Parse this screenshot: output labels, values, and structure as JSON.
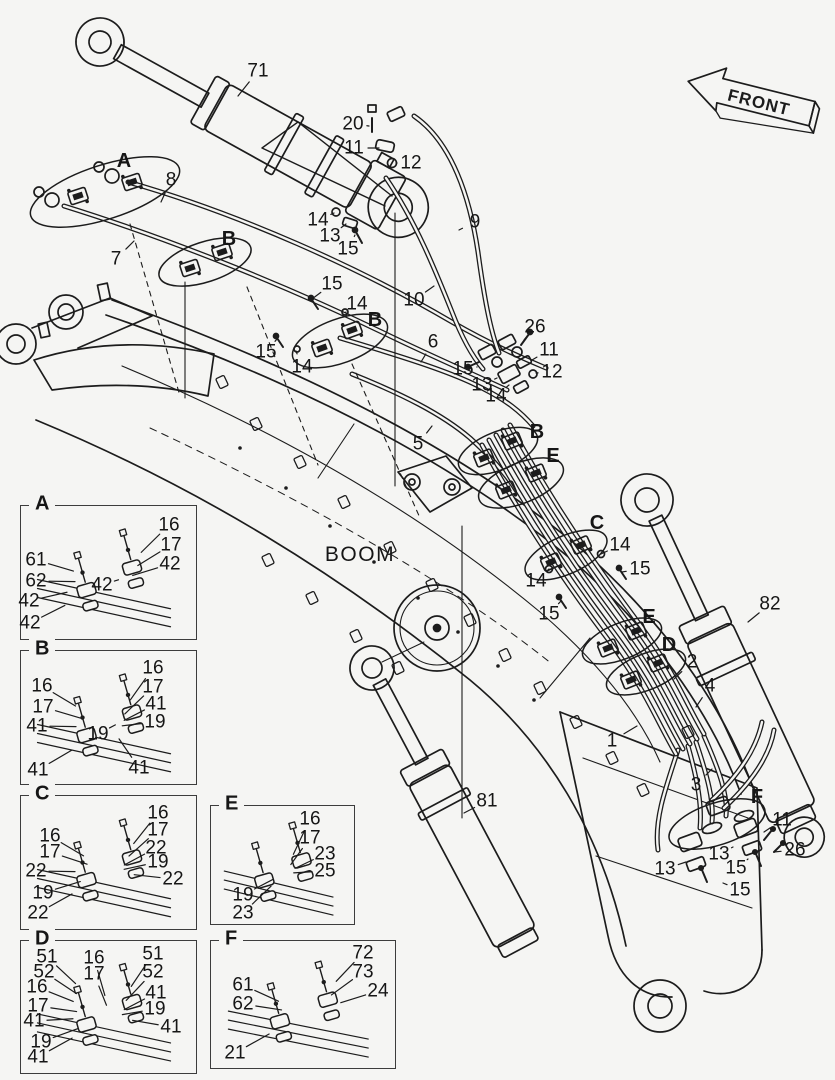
{
  "colors": {
    "background": "#f5f5f3",
    "line": "#1c1c1c"
  },
  "front_indicator": {
    "label": "FRONT"
  },
  "main_diagram": {
    "name_label": "BOOM",
    "part_labels": [
      {
        "text": "71",
        "x": 258,
        "y": 71,
        "lx": 238,
        "ly": 96
      },
      {
        "text": "20",
        "x": 353,
        "y": 124,
        "lx": 369,
        "ly": 126
      },
      {
        "text": "11",
        "x": 354,
        "y": 148,
        "lx": 379,
        "ly": 148
      },
      {
        "text": "12",
        "x": 411,
        "y": 163,
        "lx": 396,
        "ly": 163
      },
      {
        "text": "9",
        "x": 475,
        "y": 222,
        "lx": 459,
        "ly": 230
      },
      {
        "text": "14",
        "x": 318,
        "y": 220,
        "lx": 334,
        "ly": 213
      },
      {
        "text": "13",
        "x": 330,
        "y": 236,
        "lx": 346,
        "ly": 224
      },
      {
        "text": "15",
        "x": 348,
        "y": 249,
        "lx": 355,
        "ly": 235
      },
      {
        "text": "10",
        "x": 414,
        "y": 300,
        "lx": 434,
        "ly": 286
      },
      {
        "text": "A",
        "x": 124,
        "y": 161,
        "style": "letter"
      },
      {
        "text": "8",
        "x": 171,
        "y": 180,
        "lx": 161,
        "ly": 202
      },
      {
        "text": "7",
        "x": 116,
        "y": 259,
        "lx": 134,
        "ly": 241
      },
      {
        "text": "B",
        "x": 229,
        "y": 239,
        "style": "letter"
      },
      {
        "text": "15",
        "x": 332,
        "y": 284,
        "lx": 312,
        "ly": 299
      },
      {
        "text": "14",
        "x": 357,
        "y": 304,
        "lx": 346,
        "ly": 312
      },
      {
        "text": "15",
        "x": 266,
        "y": 352,
        "lx": 277,
        "ly": 339
      },
      {
        "text": "14",
        "x": 302,
        "y": 367,
        "lx": 296,
        "ly": 351
      },
      {
        "text": "B",
        "x": 375,
        "y": 320,
        "style": "letter"
      },
      {
        "text": "6",
        "x": 433,
        "y": 342,
        "lx": 421,
        "ly": 362
      },
      {
        "text": "26",
        "x": 535,
        "y": 327,
        "lx": 524,
        "ly": 340
      },
      {
        "text": "11",
        "x": 549,
        "y": 350,
        "lx": 532,
        "ly": 360
      },
      {
        "text": "12",
        "x": 552,
        "y": 372,
        "lx": 536,
        "ly": 373
      },
      {
        "text": "15",
        "x": 463,
        "y": 369,
        "lx": 477,
        "ly": 367
      },
      {
        "text": "13",
        "x": 482,
        "y": 385,
        "lx": 497,
        "ly": 378
      },
      {
        "text": "14",
        "x": 496,
        "y": 396,
        "lx": 509,
        "ly": 385
      },
      {
        "text": "5",
        "x": 418,
        "y": 444,
        "lx": 432,
        "ly": 426
      },
      {
        "text": "B",
        "x": 537,
        "y": 432,
        "style": "letter"
      },
      {
        "text": "E",
        "x": 553,
        "y": 456,
        "style": "letter"
      },
      {
        "text": "C",
        "x": 597,
        "y": 523,
        "style": "letter"
      },
      {
        "text": "14",
        "x": 620,
        "y": 545,
        "lx": 601,
        "ly": 554
      },
      {
        "text": "15",
        "x": 640,
        "y": 569,
        "lx": 622,
        "ly": 572
      },
      {
        "text": "14",
        "x": 536,
        "y": 581,
        "lx": 549,
        "ly": 569
      },
      {
        "text": "15",
        "x": 549,
        "y": 614,
        "lx": 561,
        "ly": 601
      },
      {
        "text": "E",
        "x": 649,
        "y": 617,
        "style": "letter"
      },
      {
        "text": "D",
        "x": 669,
        "y": 645,
        "style": "letter"
      },
      {
        "text": "2",
        "x": 692,
        "y": 662,
        "lx": 674,
        "ly": 679
      },
      {
        "text": "4",
        "x": 710,
        "y": 686,
        "lx": 696,
        "ly": 707
      },
      {
        "text": "82",
        "x": 770,
        "y": 604,
        "lx": 748,
        "ly": 622
      },
      {
        "text": "1",
        "x": 612,
        "y": 741,
        "lx": 637,
        "ly": 726
      },
      {
        "text": "3",
        "x": 696,
        "y": 785,
        "lx": 712,
        "ly": 769
      },
      {
        "text": "F",
        "x": 757,
        "y": 797,
        "style": "letter"
      },
      {
        "text": "11",
        "x": 782,
        "y": 820,
        "lx": 764,
        "ly": 832
      },
      {
        "text": "26",
        "x": 795,
        "y": 850,
        "lx": 774,
        "ly": 852
      },
      {
        "text": "13",
        "x": 719,
        "y": 854,
        "lx": 733,
        "ly": 847
      },
      {
        "text": "15",
        "x": 736,
        "y": 868,
        "lx": 748,
        "ly": 859
      },
      {
        "text": "13",
        "x": 665,
        "y": 869,
        "lx": 686,
        "ly": 862
      },
      {
        "text": "15",
        "x": 740,
        "y": 890,
        "lx": 723,
        "ly": 883
      },
      {
        "text": "81",
        "x": 487,
        "y": 801,
        "lx": 464,
        "ly": 813
      }
    ]
  },
  "detail_boxes": [
    {
      "id": "A",
      "title": "A",
      "x": 20,
      "y": 505,
      "w": 175,
      "h": 133,
      "labels": [
        {
          "text": "16",
          "x": 169,
          "y": 525
        },
        {
          "text": "17",
          "x": 171,
          "y": 545
        },
        {
          "text": "42",
          "x": 170,
          "y": 564
        },
        {
          "text": "61",
          "x": 36,
          "y": 560
        },
        {
          "text": "62",
          "x": 36,
          "y": 581
        },
        {
          "text": "42",
          "x": 29,
          "y": 601
        },
        {
          "text": "42",
          "x": 102,
          "y": 585
        },
        {
          "text": "42",
          "x": 30,
          "y": 623
        }
      ]
    },
    {
      "id": "B",
      "title": "B",
      "x": 20,
      "y": 650,
      "w": 175,
      "h": 133,
      "labels": [
        {
          "text": "16",
          "x": 153,
          "y": 668
        },
        {
          "text": "17",
          "x": 153,
          "y": 687
        },
        {
          "text": "41",
          "x": 156,
          "y": 704
        },
        {
          "text": "19",
          "x": 155,
          "y": 722
        },
        {
          "text": "16",
          "x": 42,
          "y": 686
        },
        {
          "text": "17",
          "x": 43,
          "y": 707
        },
        {
          "text": "41",
          "x": 37,
          "y": 726
        },
        {
          "text": "19",
          "x": 98,
          "y": 734
        },
        {
          "text": "41",
          "x": 38,
          "y": 770
        },
        {
          "text": "41",
          "x": 139,
          "y": 768
        }
      ]
    },
    {
      "id": "C",
      "title": "C",
      "x": 20,
      "y": 795,
      "w": 175,
      "h": 133,
      "labels": [
        {
          "text": "16",
          "x": 158,
          "y": 813
        },
        {
          "text": "17",
          "x": 158,
          "y": 830
        },
        {
          "text": "22",
          "x": 156,
          "y": 848
        },
        {
          "text": "19",
          "x": 158,
          "y": 862
        },
        {
          "text": "22",
          "x": 173,
          "y": 879
        },
        {
          "text": "16",
          "x": 50,
          "y": 836
        },
        {
          "text": "17",
          "x": 50,
          "y": 852
        },
        {
          "text": "22",
          "x": 36,
          "y": 871
        },
        {
          "text": "19",
          "x": 43,
          "y": 893
        },
        {
          "text": "22",
          "x": 38,
          "y": 913
        }
      ]
    },
    {
      "id": "E",
      "title": "E",
      "x": 210,
      "y": 805,
      "w": 143,
      "h": 118,
      "labels": [
        {
          "text": "16",
          "x": 310,
          "y": 819
        },
        {
          "text": "17",
          "x": 310,
          "y": 838
        },
        {
          "text": "23",
          "x": 325,
          "y": 854
        },
        {
          "text": "25",
          "x": 325,
          "y": 871
        },
        {
          "text": "19",
          "x": 243,
          "y": 895
        },
        {
          "text": "23",
          "x": 243,
          "y": 913
        }
      ]
    },
    {
      "id": "D",
      "title": "D",
      "x": 20,
      "y": 940,
      "w": 175,
      "h": 132,
      "labels": [
        {
          "text": "51",
          "x": 47,
          "y": 957
        },
        {
          "text": "52",
          "x": 44,
          "y": 972
        },
        {
          "text": "16",
          "x": 37,
          "y": 987
        },
        {
          "text": "17",
          "x": 38,
          "y": 1006
        },
        {
          "text": "41",
          "x": 34,
          "y": 1021
        },
        {
          "text": "19",
          "x": 41,
          "y": 1042
        },
        {
          "text": "41",
          "x": 38,
          "y": 1057
        },
        {
          "text": "16",
          "x": 94,
          "y": 958
        },
        {
          "text": "17",
          "x": 94,
          "y": 974
        },
        {
          "text": "51",
          "x": 153,
          "y": 954
        },
        {
          "text": "52",
          "x": 153,
          "y": 972
        },
        {
          "text": "41",
          "x": 156,
          "y": 993
        },
        {
          "text": "19",
          "x": 155,
          "y": 1009
        },
        {
          "text": "41",
          "x": 171,
          "y": 1027
        }
      ]
    },
    {
      "id": "F",
      "title": "F",
      "x": 210,
      "y": 940,
      "w": 184,
      "h": 127,
      "labels": [
        {
          "text": "72",
          "x": 363,
          "y": 953
        },
        {
          "text": "73",
          "x": 363,
          "y": 972
        },
        {
          "text": "61",
          "x": 243,
          "y": 985
        },
        {
          "text": "62",
          "x": 243,
          "y": 1004
        },
        {
          "text": "24",
          "x": 378,
          "y": 991
        },
        {
          "text": "21",
          "x": 235,
          "y": 1053
        }
      ]
    }
  ]
}
